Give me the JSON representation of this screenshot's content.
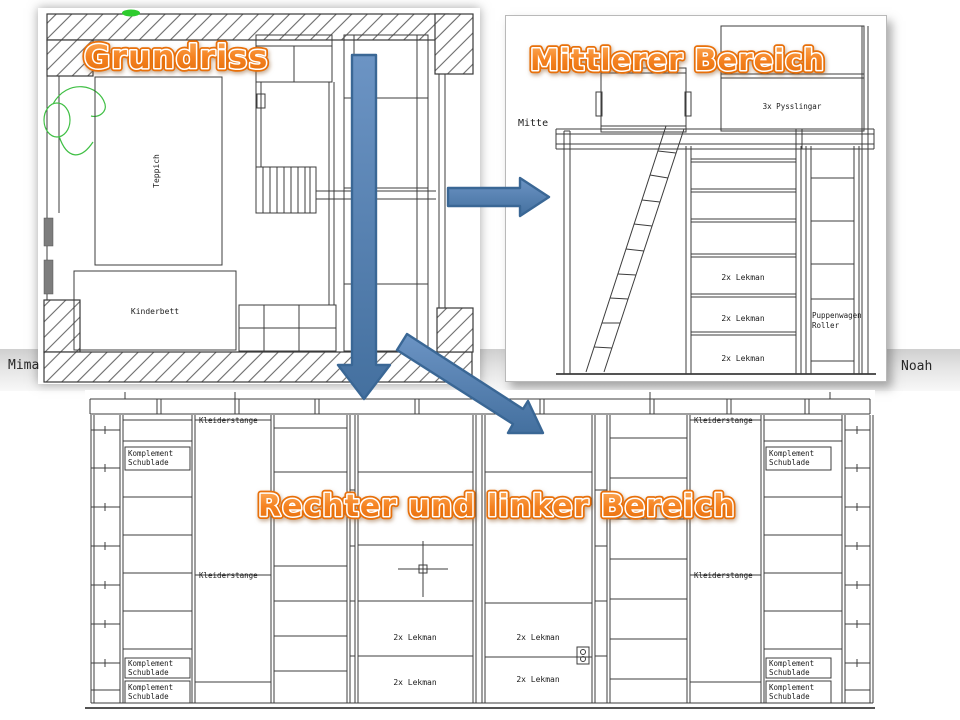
{
  "titles": {
    "floor_plan": "Grundriss",
    "middle_area": "Mittlerer Bereich",
    "left_right_area": "Rechter und linker Bereich"
  },
  "side_names": {
    "left": "Mima",
    "right": "Noah"
  },
  "floor_plan": {
    "teppich_label": "Teppich",
    "kinderbett_label": "Kinderbett"
  },
  "middle_area": {
    "region_label": "Mitte",
    "pysslingar_label": "3x Pysslingar",
    "lekman_label": "2x Lekman",
    "puppenwagen_line1": "Puppenwagen",
    "puppenwagen_line2": "Roller"
  },
  "wardrobe": {
    "kleiderstange_label": "Kleiderstange",
    "komplement_line1": "Komplement",
    "komplement_line2": "Schublade",
    "lekman_label": "2x Lekman"
  },
  "colors": {
    "wordart_orange": "#F58220",
    "wordart_outline": "#E8700A",
    "arrow_blue": "#4F81BD",
    "arrow_border": "#3A6795",
    "cad_line": "#3C3C3C",
    "sketch_green": "#3FBF44"
  }
}
